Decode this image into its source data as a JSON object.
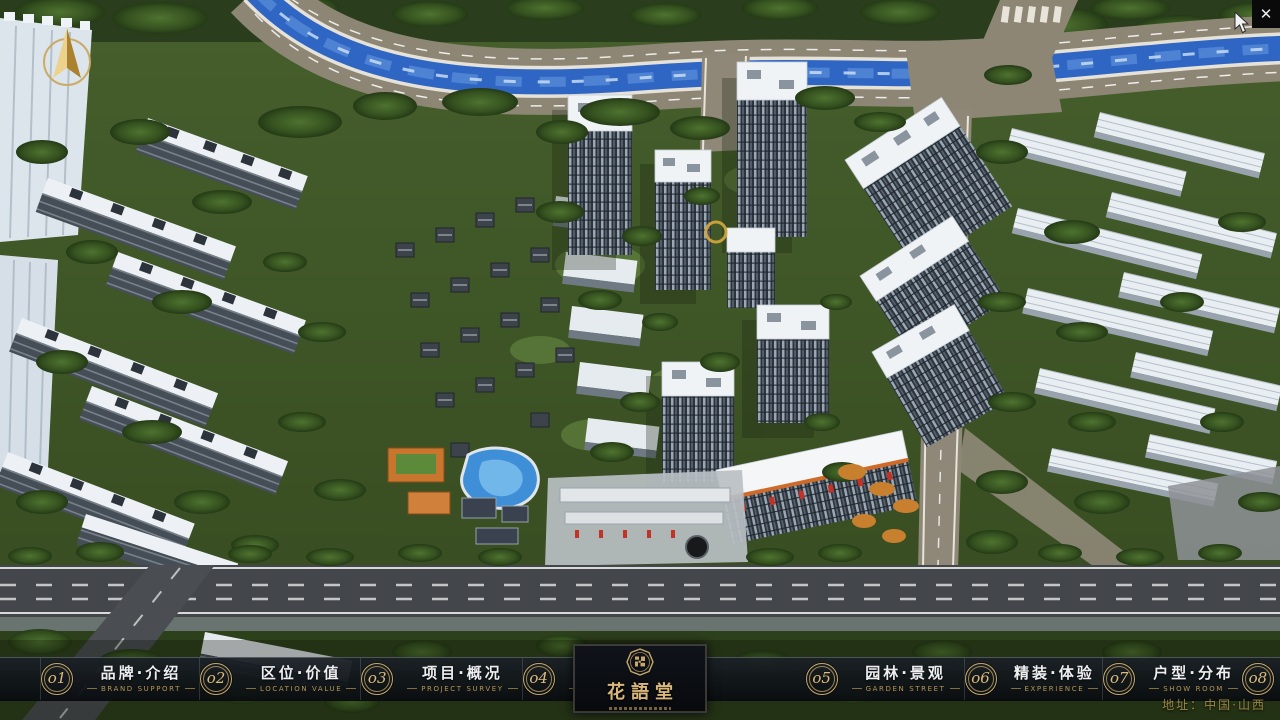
{
  "window": {
    "close_glyph": "✕"
  },
  "compass": {
    "type": "north-arrow"
  },
  "nav": {
    "items": [
      {
        "num": "o1",
        "zh": "品牌·介绍",
        "en": "BRAND SUPPORT"
      },
      {
        "num": "o2",
        "zh": "区位·价值",
        "en": "LOCATION VALUE"
      },
      {
        "num": "o3",
        "zh": "项目·概况",
        "en": "PROJECT SURVEY"
      },
      {
        "num": "o4",
        "zh": "建筑·鉴赏",
        "en": "APPRECIATION"
      },
      {
        "num": "o5",
        "zh": "园林·景观",
        "en": "GARDEN STREET"
      },
      {
        "num": "o6",
        "zh": "精装·体验",
        "en": "EXPERIENCE"
      },
      {
        "num": "o7",
        "zh": "户型·分布",
        "en": "SHOW ROOM"
      },
      {
        "num": "o8",
        "zh": "一房·一景",
        "en": "COMMUNITY"
      }
    ]
  },
  "logo": {
    "title": "花語堂"
  },
  "footer": {
    "address": "地址：中国·山西"
  },
  "colors": {
    "accent_gold": "#c9a96a",
    "nav_text": "#eceef0",
    "nav_sub_text": "#b49554",
    "river_blue": "#2f66c4",
    "navbar_bg": "rgba(13,18,24,0.92)",
    "logo_panel_bg": "#0a0d12"
  }
}
